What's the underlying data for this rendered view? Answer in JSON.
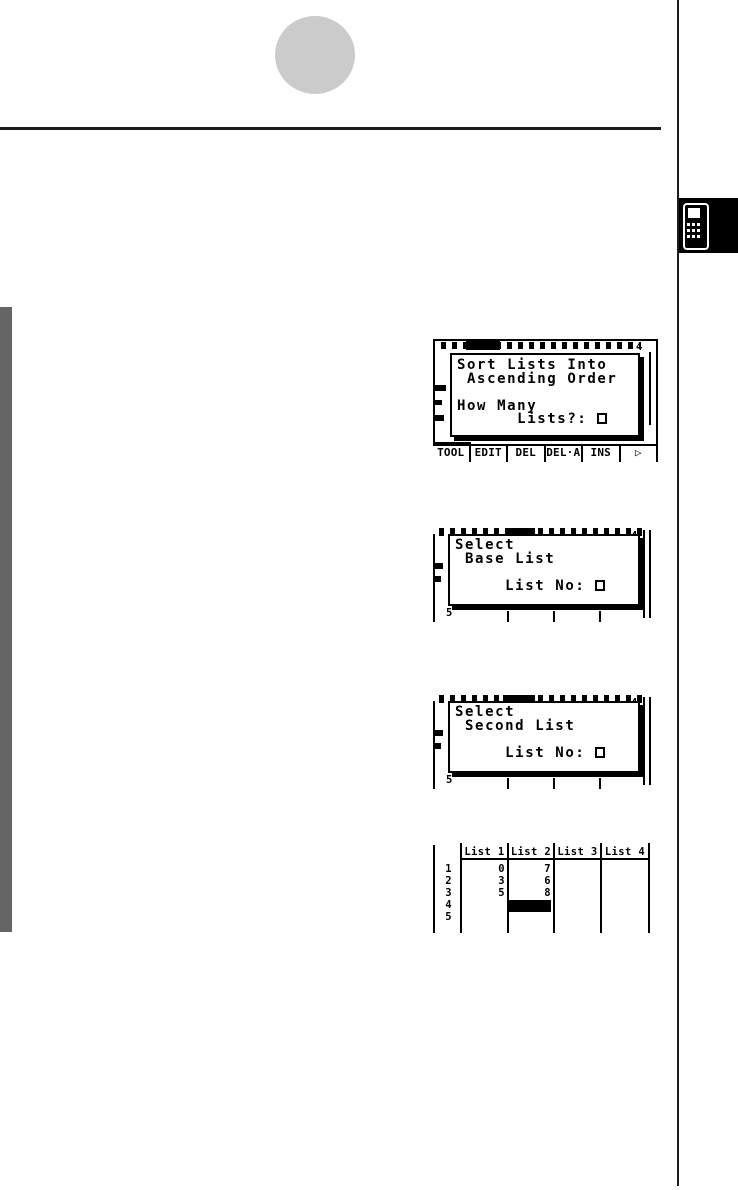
{
  "screens": {
    "sort": {
      "lines": [
        "Sort Lists Into",
        " Ascending Order",
        "",
        "How Many"
      ],
      "prompt": "      Lists?: ",
      "list4_indicator": "4",
      "menu": [
        "TOOL",
        "EDIT",
        "DEL",
        "DEL·A",
        "INS",
        "▷"
      ]
    },
    "base": {
      "lines": [
        "Select",
        " Base List",
        ""
      ],
      "prompt": "     List No: ",
      "list4_indicator": "4",
      "row5_indicator": "5"
    },
    "second": {
      "lines": [
        "Select",
        " Second List",
        ""
      ],
      "prompt": "     List No: ",
      "list4_indicator": "4",
      "row5_indicator": "5"
    },
    "table": {
      "columns": [
        "List 1",
        "List 2",
        "List 3",
        "List 4"
      ],
      "rows": [
        {
          "n": "1",
          "list1": "0",
          "list2": "7",
          "list3": "",
          "list4": ""
        },
        {
          "n": "2",
          "list1": "3",
          "list2": "6",
          "list3": "",
          "list4": ""
        },
        {
          "n": "3",
          "list1": "5",
          "list2": "8",
          "list3": "",
          "list4": ""
        },
        {
          "n": "4",
          "list1": "",
          "list2": "",
          "list3": "",
          "list4": ""
        },
        {
          "n": "5",
          "list1": "",
          "list2": "",
          "list3": "",
          "list4": ""
        }
      ],
      "selected_cell": {
        "row": "4",
        "column": "List 2"
      }
    }
  }
}
